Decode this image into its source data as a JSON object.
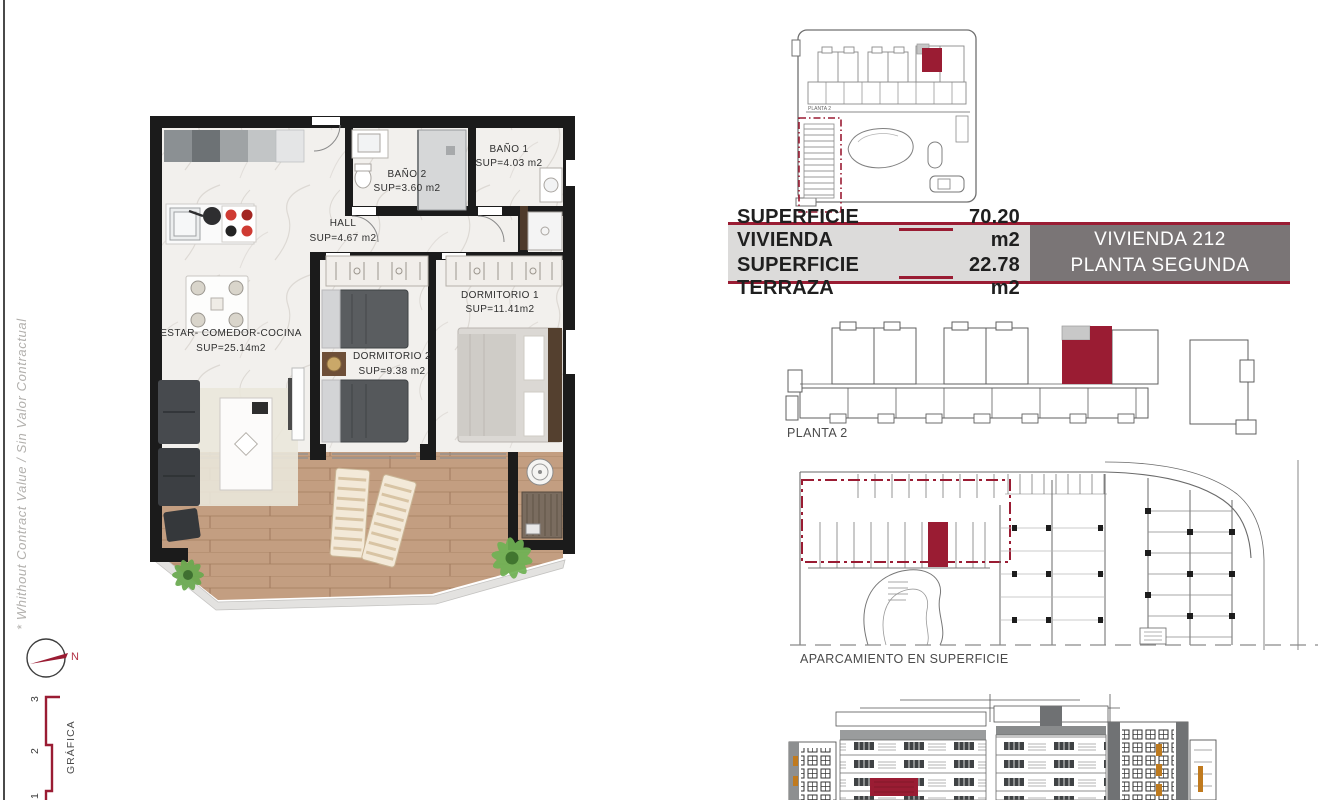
{
  "side": {
    "note": "* Whithout Contract Value / Sin Valor Contractual",
    "compass_n": "N",
    "scale_label": "GRÁFICA",
    "scale_ticks": [
      "3",
      "2",
      "1"
    ]
  },
  "plan": {
    "rooms": [
      {
        "name": "BAÑO 1",
        "sup": "SUP=4.03 m2"
      },
      {
        "name": "BAÑO 2",
        "sup": "SUP=3.60 m2"
      },
      {
        "name": "HALL",
        "sup": "SUP=4.67 m2"
      },
      {
        "name": "ESTAR- COMEDOR-COCINA",
        "sup": "SUP=25.14m2"
      },
      {
        "name": "DORMITORIO 2",
        "sup": "SUP=9.38 m2"
      },
      {
        "name": "DORMITORIO 1",
        "sup": "SUP=11.41m2"
      }
    ]
  },
  "summary": {
    "rows": [
      {
        "label": "SUPERFICIE VIVIENDA",
        "value": "70.20 m2"
      },
      {
        "label": "SUPERFICIE TERRAZA",
        "value": "22.78 m2"
      }
    ],
    "unit": "VIVIENDA 212",
    "floor": "PLANTA SEGUNDA"
  },
  "diagrams": {
    "site_label": "PLANTA 2",
    "planta_label": "PLANTA 2",
    "parking_label": "APARCAMIENTO EN SUPERFICIE"
  },
  "colors": {
    "accent": "#9a1c33",
    "box_gray": "#7a7576",
    "panel_gray": "#dcdbda"
  }
}
